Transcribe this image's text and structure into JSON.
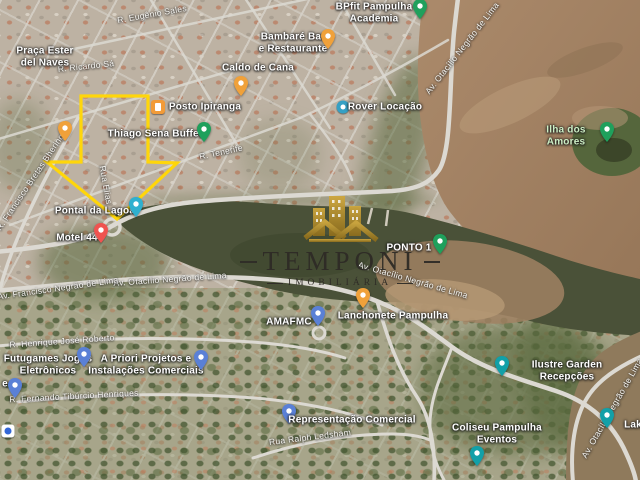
{
  "watermark": {
    "title": "TEMPONI",
    "subtitle": "IMOBILIÁRIA"
  },
  "annotation": {
    "shape": "down-arrow-outline",
    "color": "#ffd60a"
  },
  "colors": {
    "annotation_yellow": "#ffd60a",
    "brand_gold": "#b8922e",
    "brand_text": "#2e2b26",
    "water_dark": "#4a5138",
    "water_silt": "#a8876a",
    "road": "#dcd9d2",
    "poi_green": "#1fa05c",
    "poi_food": "#f0a13a",
    "poi_blue": "#5a80d6",
    "poi_teal": "#12a0a8",
    "poi_red": "#ef5350",
    "poi_water": "#2fb0cf"
  },
  "pois": [
    {
      "label": "BPfit Pampulha\nAcademia",
      "type": "green"
    },
    {
      "label": "Bambaré Bar\ne Restaurante",
      "type": "food"
    },
    {
      "label": "Caldo de Cana",
      "type": "food"
    },
    {
      "label": "Posto Ipiranga",
      "type": "gas"
    },
    {
      "label": "Thiago Sena Buffet",
      "type": "green"
    },
    {
      "label": "Rover Locação",
      "type": "service"
    },
    {
      "label": "Ilha dos Amores",
      "type": "green"
    },
    {
      "label": "Pontal da Lagoa",
      "type": "water"
    },
    {
      "label": "Motel 44",
      "type": "red"
    },
    {
      "label": "PONTO 1",
      "type": "green"
    },
    {
      "label": "AMAFMC",
      "type": "blue"
    },
    {
      "label": "Lanchonete Pampulha",
      "type": "food"
    },
    {
      "label": "Futugames Jogos\nEletrônicos",
      "type": "blue"
    },
    {
      "label": "A Priori Projetos e\nInstalações Comerciais",
      "type": "blue"
    },
    {
      "label": "e",
      "type": "blue"
    },
    {
      "label": "Representação Comercial",
      "type": "blue"
    },
    {
      "label": "Ilustre Garden Recepções",
      "type": "teal"
    },
    {
      "label": "Coliseu Pampulha\nEventos",
      "type": "teal"
    },
    {
      "label": "Lak",
      "type": "teal"
    },
    {
      "label": "Praça Ester\ndel Naves",
      "type": "place"
    }
  ],
  "streets": [
    {
      "label": "R. Eugênio Sales"
    },
    {
      "label": "R. Ricardo Sá"
    },
    {
      "label": "R. Tenerife"
    },
    {
      "label": "Rua Elias"
    },
    {
      "label": "Av. Otacílio Negrão de Lima"
    },
    {
      "label": "Av. Otacílio Negrão de Lima"
    },
    {
      "label": "Av. Francisco Negrão de Lima"
    },
    {
      "label": "Av. Otacílio Negrão de Lima"
    },
    {
      "label": "Av. Otacílio Negrão de Lima"
    },
    {
      "label": "R. Henrique José Roberto"
    },
    {
      "label": "R. Fernando Tibúrcio Henriques"
    },
    {
      "label": "R. Francisco Bretas Bhering"
    },
    {
      "label": "Rua Ralph Ledsham"
    }
  ]
}
